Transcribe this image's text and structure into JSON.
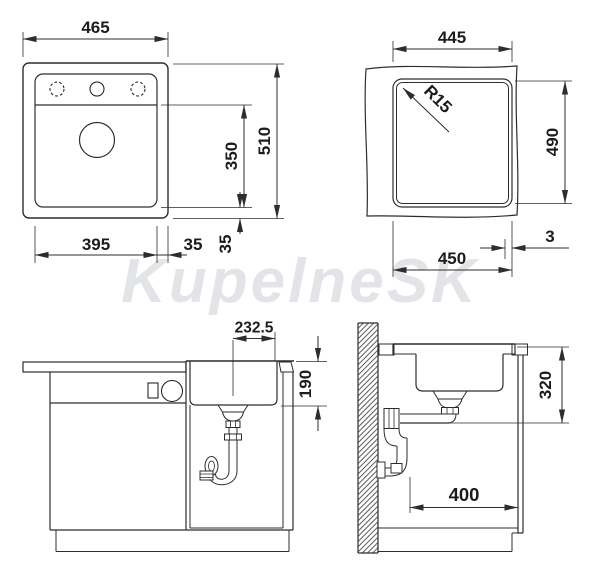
{
  "watermark": "KupelneSK",
  "colors": {
    "line": "#2d2d2d",
    "dimension_text": "#1c1c1c",
    "watermark": "#cbced6",
    "background": "#ffffff"
  },
  "top_view": {
    "overall_width": "465",
    "overall_depth": "510",
    "bowl_depth_position": "350",
    "bowl_width": "395",
    "edge_gap_right": "35",
    "edge_gap_bottom": "35"
  },
  "cutout_view": {
    "width_top": "445",
    "height": "490",
    "width_bottom": "450",
    "corner_radius": "R15",
    "edge_offset": "3"
  },
  "front_view": {
    "drain_center_offset": "232.5",
    "bowl_depth": "190"
  },
  "side_view": {
    "drain_outlet_height": "320",
    "base_clearance": "400"
  }
}
